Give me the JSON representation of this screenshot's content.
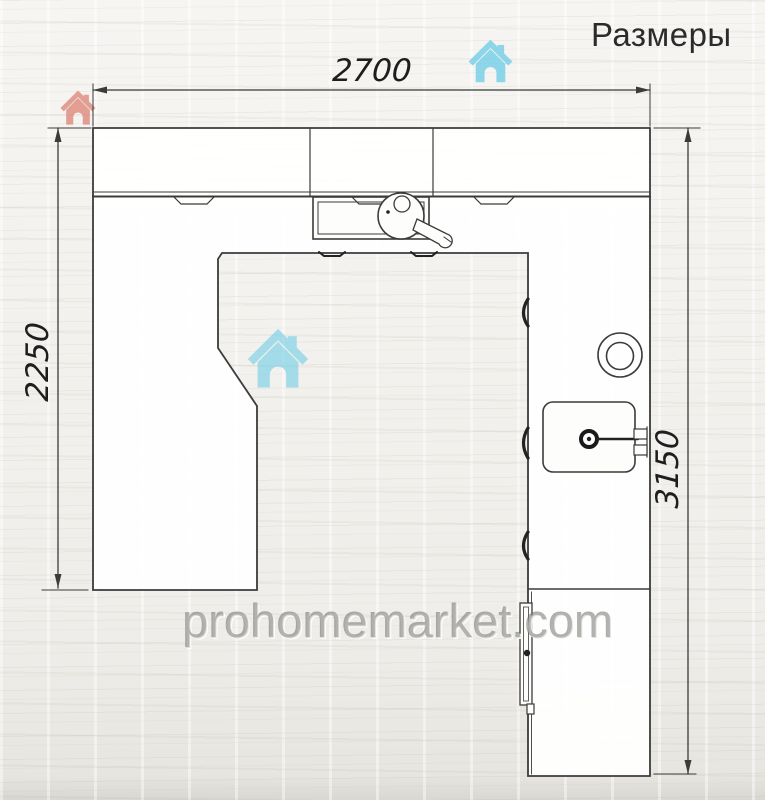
{
  "title": "Размеры",
  "dimensions": {
    "top_width_mm": "2700",
    "left_height_mm": "2250",
    "right_height_mm": "3150"
  },
  "watermark": "prohomemarket.com",
  "plan": {
    "type": "kitchen-floor-plan-top-view",
    "shape": "u-shaped-counter-open-at-bottom",
    "elements": [
      "wall-cabinet-row-top",
      "countertop-band",
      "cooktop-with-frying-pan",
      "round-hob",
      "sink-with-faucet",
      "left-base-cabinet-leg",
      "right-base-cabinet-leg",
      "tall-cabinet-bottom-right",
      "cabinet-door-handles"
    ]
  },
  "colors": {
    "line": "#3b3b3b",
    "counter_fill": "#fdfdfb",
    "title_text": "#2b2b2b",
    "dimension_text": "#1e1e1e",
    "watermark_text": "#b9b8b4",
    "red_house": "#dd7d72",
    "blue_house": "#74cfe8",
    "background": "#f2f0ec"
  },
  "icons": {
    "red_house_logo": "house-icon",
    "blue_house_logo": "house-icon"
  }
}
